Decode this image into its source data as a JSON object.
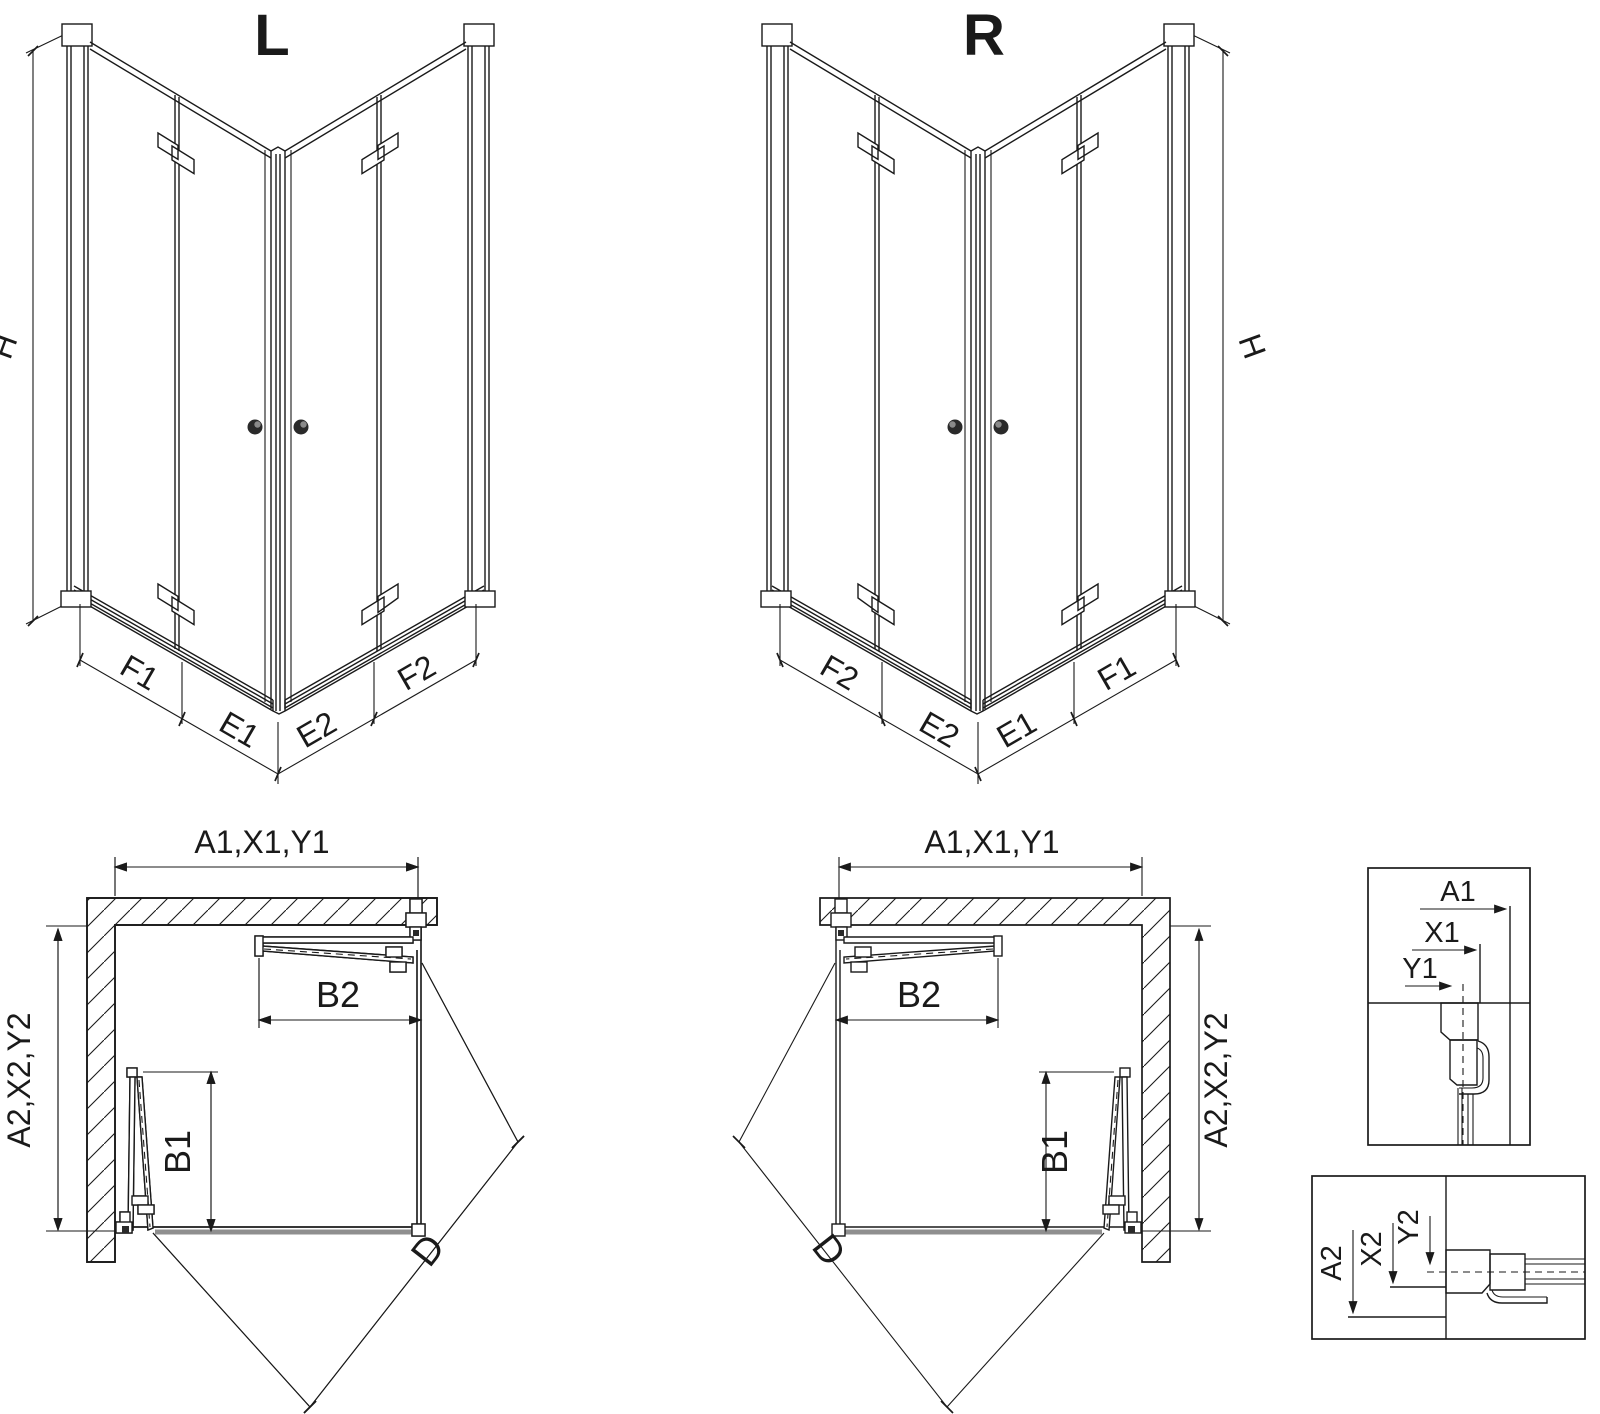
{
  "drawing": {
    "variant_left": {
      "title": "L",
      "height_label": "H",
      "segments": {
        "f1": "F1",
        "e1": "E1",
        "e2": "E2",
        "f2": "F2"
      }
    },
    "variant_right": {
      "title": "R",
      "height_label": "H",
      "segments": {
        "f1": "F1",
        "e1": "E1",
        "e2": "E2",
        "f2": "F2"
      }
    },
    "plan_left": {
      "width_label": "A1,X1,Y1",
      "depth_label": "A2,X2,Y2",
      "door1_label": "B1",
      "door2_label": "B2",
      "diagonal_label": "D"
    },
    "plan_right": {
      "width_label": "A1,X1,Y1",
      "depth_label": "A2,X2,Y2",
      "door1_label": "B1",
      "door2_label": "B2",
      "diagonal_label": "D"
    },
    "detail_top": {
      "a1": "A1",
      "x1": "X1",
      "y1": "Y1"
    },
    "detail_bottom": {
      "a2": "A2",
      "x2": "X2",
      "y2": "Y2"
    },
    "colors": {
      "line": "#1a1a1a",
      "tray_edge": "#8f8f8f",
      "background": "#ffffff"
    }
  }
}
